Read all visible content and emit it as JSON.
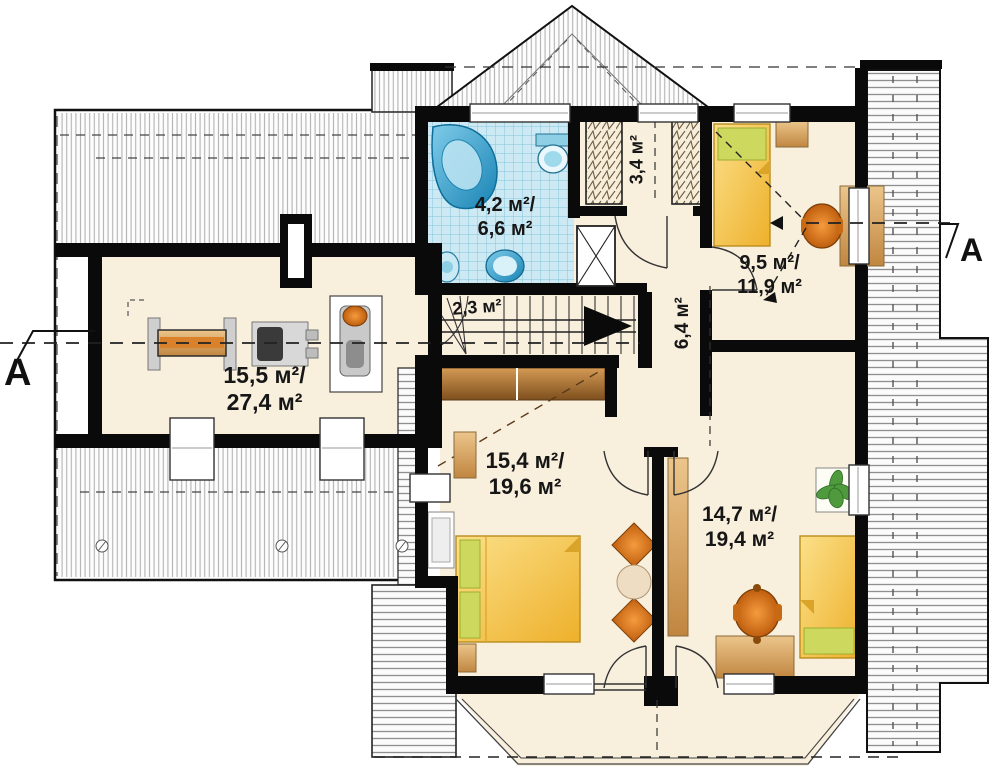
{
  "plan": {
    "kind": "attic floor plan",
    "section_marker_left": "A",
    "section_marker_right": "A",
    "rooms": {
      "gym": {
        "area_line1": "15,5 м²/",
        "area_line2": "27,4 м²"
      },
      "bathroom": {
        "area_line1": "4,2 м²/",
        "area_line2": "6,6 м²"
      },
      "stairs": {
        "area": "2,3 м²"
      },
      "wardrobe": {
        "area": "3,4 м²"
      },
      "hall": {
        "area": "6,4 м²"
      },
      "bedroom_top_right": {
        "area_line1": "9,5 м²/",
        "area_line2": "11,9 м²"
      },
      "bedroom_bottom_left": {
        "area_line1": "15,4 м²/",
        "area_line2": "19,6 м²"
      },
      "bedroom_bottom_right": {
        "area_line1": "14,7 м²/",
        "area_line2": "19,4 м²"
      }
    }
  },
  "palette": {
    "floor": "#f8efdd",
    "wall": "#0a0a0a",
    "tile_bg": "#cde9f4",
    "tile_line": "#84c5dc",
    "fixture_blue": "#2694c6",
    "bed_yellow": "#f3bf3a",
    "pillow_green": "#ccd95e",
    "wood_tan": "#dca968",
    "chair_orange": "#e0791c",
    "hatch_line": "#aaaaaa",
    "dash": "#222222"
  }
}
